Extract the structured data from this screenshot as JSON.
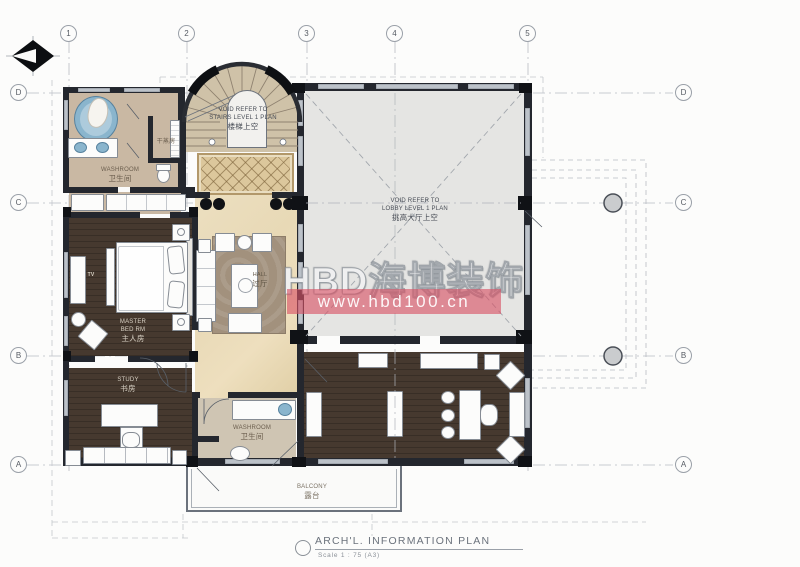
{
  "grid": {
    "top": [
      "1",
      "2",
      "3",
      "4",
      "5"
    ],
    "left": [
      "D",
      "C",
      "B",
      "A"
    ],
    "right": [
      "D",
      "C",
      "B",
      "A"
    ]
  },
  "labels": {
    "stairs_void": [
      "VOID REFER TO",
      "STAIRS LEVEL 1 PLAN",
      "楼梯上空"
    ],
    "lobby_void": [
      "VOID REFER TO",
      "LOBBY LEVEL 1 PLAN",
      "挑高大厅上空"
    ],
    "washroom_top": [
      "WASHROOM",
      "卫生间"
    ],
    "steam_room": "干蒸房",
    "bedroom": [
      "MASTER",
      "BED RM",
      "主人房"
    ],
    "tv": "TV",
    "hall": [
      "HALL",
      "过厅"
    ],
    "study": [
      "STUDY",
      "书房"
    ],
    "washroom_bottom": [
      "WASHROOM",
      "卫生间"
    ],
    "balcony": [
      "BALCONY",
      "露台"
    ]
  },
  "watermark": {
    "brand": "HBD海博装饰",
    "url": "www.hbd100.cn"
  },
  "titleblock": {
    "title": "ARCH'L. INFORMATION PLAN",
    "scale": "Scale 1 : 75 (A3)"
  },
  "colors": {
    "wall": "#24272e",
    "wood_floor": "#46392f",
    "marble_floor": "#e8d9b6",
    "bath_floor": "#c9b8a3",
    "stair_floor": "#cfc2a8",
    "void_floor": "#e5e5e3",
    "rug": "#a2917d",
    "diamond_rug": "#dcc79c",
    "fixture_blue": "#8ab5cd",
    "watermark_red": "#d95064",
    "grid_line": "#b8bcc3"
  }
}
